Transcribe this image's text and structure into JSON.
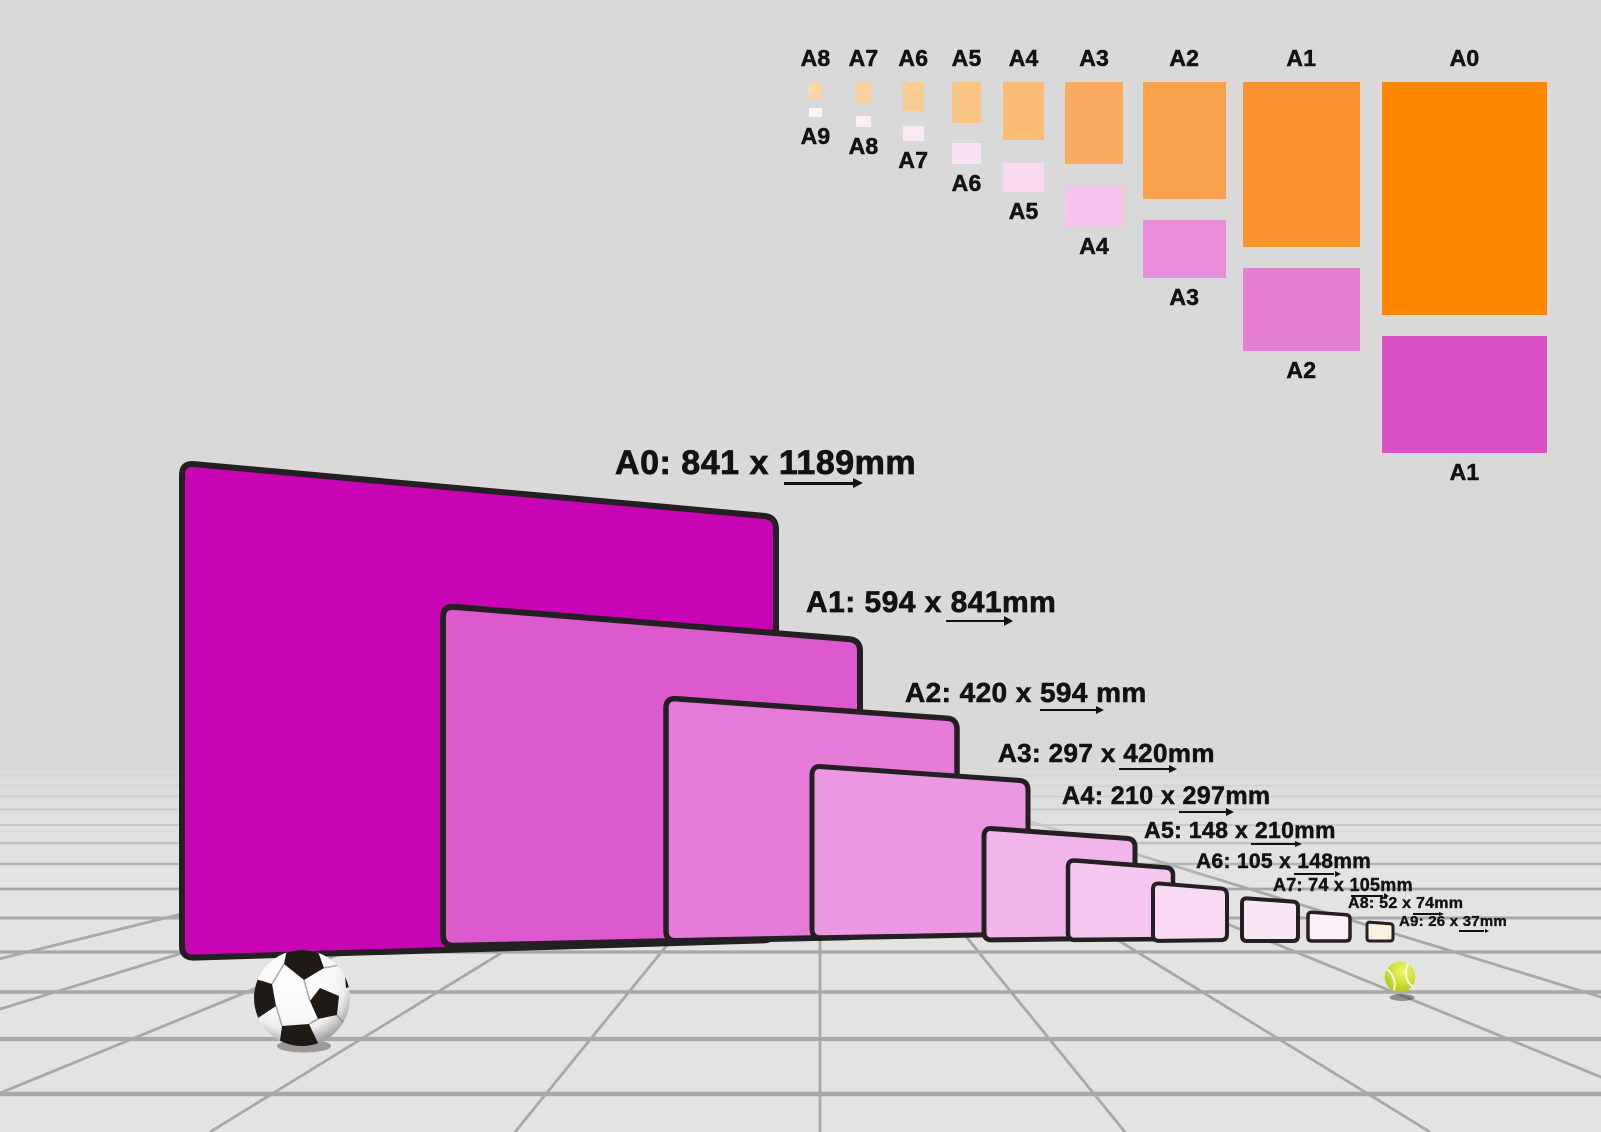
{
  "scene": {
    "sky_color": "#d9d9d9",
    "floor_color": "#e3e3e3",
    "grid_line_color": "#a8a8a8",
    "paper_border_color": "#241f22",
    "label_color": "#141114"
  },
  "standing_papers": [
    {
      "name": "A0",
      "label": "A0: 841 x 1189mm",
      "color": "#c705b5"
    },
    {
      "name": "A1",
      "label": "A1: 594 x 841mm",
      "color": "#dc59ce"
    },
    {
      "name": "A2",
      "label": "A2: 420 x 594 mm",
      "color": "#e47bd9"
    },
    {
      "name": "A3",
      "label": "A3: 297 x 420mm",
      "color": "#eb97e1"
    },
    {
      "name": "A4",
      "label": "A4: 210 x 297mm",
      "color": "#f2b5ea"
    },
    {
      "name": "A5",
      "label": "A5: 148 x 210mm",
      "color": "#f6c8ef"
    },
    {
      "name": "A6",
      "label": "A6: 105 x 148mm",
      "color": "#f8dbf3"
    },
    {
      "name": "A7",
      "label": "A7: 74 x 105mm",
      "color": "#fae7f6"
    },
    {
      "name": "A8",
      "label": "A8: 52 x 74mm",
      "color": "#fbf0f9"
    },
    {
      "name": "A9",
      "label": "A9: 26 x 37mm",
      "color": "#f8f1de"
    }
  ],
  "top_chart": {
    "columns": [
      {
        "portrait": "A8",
        "portrait_color": "#fcd6a8",
        "landscape": "A9",
        "landscape_color": "#fcf4f9"
      },
      {
        "portrait": "A7",
        "portrait_color": "#fbd19e",
        "landscape": "A8",
        "landscape_color": "#fbeff7"
      },
      {
        "portrait": "A6",
        "portrait_color": "#fbcc92",
        "landscape": "A7",
        "landscape_color": "#fae9f5"
      },
      {
        "portrait": "A5",
        "portrait_color": "#fac584",
        "landscape": "A6",
        "landscape_color": "#f9e2f2"
      },
      {
        "portrait": "A4",
        "portrait_color": "#fabb74",
        "landscape": "A5",
        "landscape_color": "#f9d9ef"
      },
      {
        "portrait": "A3",
        "portrait_color": "#f9aa5e",
        "landscape": "A4",
        "landscape_color": "#f8c4ed"
      },
      {
        "portrait": "A2",
        "portrait_color": "#f9a04a",
        "landscape": "A3",
        "landscape_color": "#e88ed9"
      },
      {
        "portrait": "A1",
        "portrait_color": "#f99330",
        "landscape": "A2",
        "landscape_color": "#e47fd2"
      },
      {
        "portrait": "A0",
        "portrait_color": "#fb8800",
        "landscape": "A1",
        "landscape_color": "#d852c6"
      }
    ]
  },
  "objects": {
    "soccer_ball": {
      "panel_color": "#201a16",
      "body_color": "#ffffff"
    },
    "tennis_ball": {
      "body_color": "#c6da2b",
      "seam_color": "#f4f9da"
    }
  }
}
